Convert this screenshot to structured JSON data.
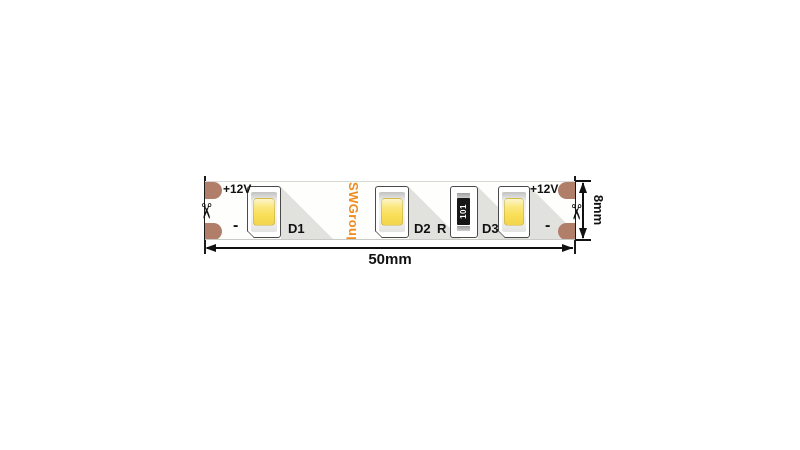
{
  "diagram": {
    "brand": "SWGroup",
    "scissors_glyph": "✂",
    "left_contacts": {
      "voltage": "+12V",
      "minus": "-"
    },
    "right_contacts": {
      "voltage": "+12V",
      "minus": "-"
    },
    "leds": [
      {
        "label": "D1"
      },
      {
        "label": "D2"
      },
      {
        "label": "D3"
      }
    ],
    "resistor": {
      "label": "R",
      "marking": "101"
    },
    "dimensions": {
      "length": "50mm",
      "height": "8mm"
    },
    "colors": {
      "brand_orange": "#ef8c1e",
      "pad_copper": "#b17e6a",
      "led_chip_yellow": "#f8df55",
      "shadow_gray": "#e1e1de",
      "outline_gray": "#4a4a4a"
    }
  }
}
